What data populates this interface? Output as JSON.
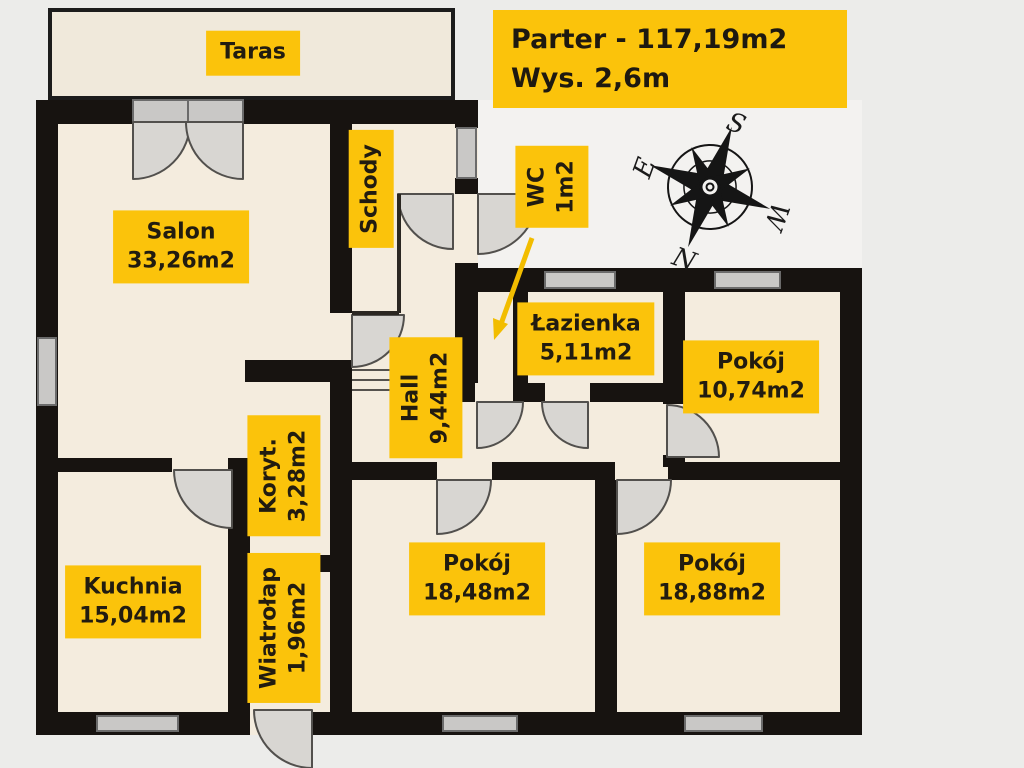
{
  "title": {
    "line1": "Parter - 117,19m2",
    "line2": "Wys. 2,6m"
  },
  "rooms": [
    {
      "id": "taras",
      "name": "Taras",
      "area": "",
      "cx": 253,
      "cy": 53,
      "vertical": false
    },
    {
      "id": "salon",
      "name": "Salon",
      "area": "33,26m2",
      "cx": 181,
      "cy": 247,
      "vertical": false
    },
    {
      "id": "schody",
      "name": "Schody",
      "area": "",
      "cx": 371,
      "cy": 189,
      "vertical": true
    },
    {
      "id": "wc",
      "name": "WC",
      "area": "1m2",
      "cx": 552,
      "cy": 187,
      "vertical": true
    },
    {
      "id": "lazienka",
      "name": "Łazienka",
      "area": "5,11m2",
      "cx": 586,
      "cy": 339,
      "vertical": false
    },
    {
      "id": "pokoj-1074",
      "name": "Pokój",
      "area": "10,74m2",
      "cx": 751,
      "cy": 377,
      "vertical": false
    },
    {
      "id": "hall",
      "name": "Hall",
      "area": "9,44m2",
      "cx": 426,
      "cy": 398,
      "vertical": true
    },
    {
      "id": "koryt",
      "name": "Koryt.",
      "area": "3,28m2",
      "cx": 284,
      "cy": 476,
      "vertical": true
    },
    {
      "id": "kuchnia",
      "name": "Kuchnia",
      "area": "15,04m2",
      "cx": 133,
      "cy": 602,
      "vertical": false
    },
    {
      "id": "wiatrolap",
      "name": "Wiatrołap",
      "area": "1,96m2",
      "cx": 284,
      "cy": 628,
      "vertical": true
    },
    {
      "id": "pokoj-1848",
      "name": "Pokój",
      "area": "18,48m2",
      "cx": 477,
      "cy": 579,
      "vertical": false
    },
    {
      "id": "pokoj-1888",
      "name": "Pokój",
      "area": "18,88m2",
      "cx": 712,
      "cy": 579,
      "vertical": false
    }
  ],
  "compass": {
    "n": "N",
    "s": "S",
    "e": "E",
    "w": "W"
  },
  "colors": {
    "accent_yellow": "#FBC30B",
    "wall_black": "#171310",
    "room_fill": "#F4ECDE",
    "terrace_fill": "#F0E9DB",
    "door_gray": "#D8D6D2",
    "window_gray": "#C9C8C6",
    "background": "#ECECEA"
  }
}
